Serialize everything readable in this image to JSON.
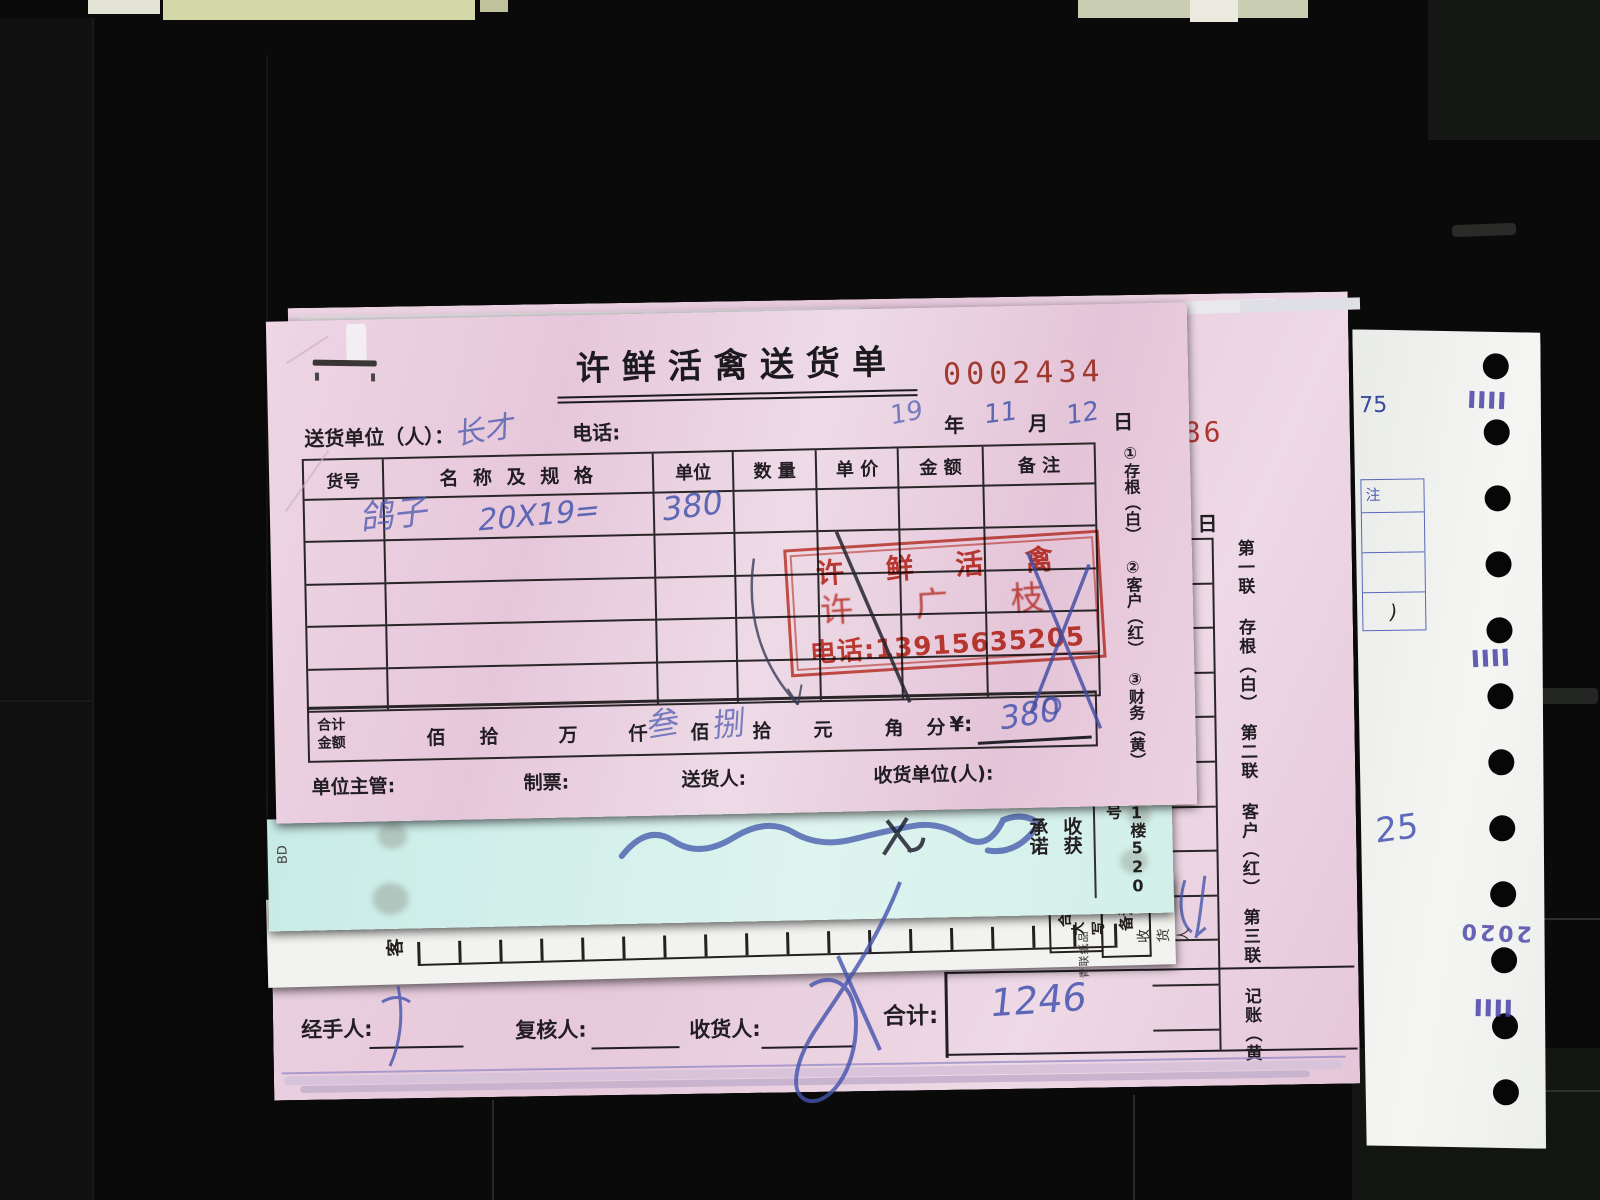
{
  "main_receipt": {
    "title": "许鲜活禽送货单",
    "serial": "0002434",
    "consignor_label": "送货单位（人）：",
    "consignor_hw": "长才",
    "phone_label": "电话:",
    "year_hw": "19",
    "year_label": "年",
    "month_hw": "11",
    "month_label": "月",
    "day_hw": "12",
    "day_label": "日",
    "headers": [
      "货号",
      "名 称 及 规 格",
      "单位",
      "数 量",
      "单 价",
      "金 额",
      "备 注"
    ],
    "item_name": "鸽子",
    "item_spec": "20X19=",
    "item_amount": "380",
    "copies": [
      "①存根（白）",
      "②客户（红）",
      "③财务（黄）"
    ],
    "stamp": {
      "line1": "许 鲜 活 禽",
      "line2": "许 广 枝",
      "line3": "电话:13915635205"
    },
    "total": {
      "label1": "合计",
      "label2": "金额",
      "units": [
        "佰",
        "拾",
        "万",
        "仟",
        "佰",
        "拾",
        "元",
        "角",
        "分"
      ],
      "currency": "¥:",
      "caps1": "叁",
      "caps2": "捌",
      "amount": "380"
    },
    "supervisor_label": "单位主管:",
    "ticket_label": "制票:",
    "deliverer_label": "送货人:",
    "receiver_label": "收货单位(人):"
  },
  "second_receipt": {
    "serial": "486",
    "day_label": "日",
    "note_label": "注",
    "copies_vertical": "第一联 存根（白）　第二联 客户（红）　第三联 记账（黄）",
    "handler_label": "经手人:",
    "reviewer_label": "复核人:",
    "receiver_label": "收货人:",
    "total_label": "合计:",
    "total_hw": "1246"
  },
  "cyan_sheet": {
    "corner_mark": "BD",
    "promise_col1": "承诺",
    "promise_col2": "收获",
    "address": "1楼520号"
  },
  "white_sheet": {
    "customer_label": "客",
    "caps_col1": "合计",
    "caps_col2": "大写",
    "note_label": "备注",
    "receiver_label": "收货人",
    "maker": "青联纸品"
  },
  "tractor_paper": {
    "page_no": "75",
    "note_label": "注",
    "bracket": ")",
    "hw_number": "25",
    "stamp_digits": "2020"
  },
  "colors": {
    "receipt_pink": "#e8cbdc",
    "cyan": "#cdeee9",
    "stamp_red": "#c12a1a",
    "serial_red": "#a03a30",
    "pen_blue": "#4656ae",
    "paper_white": "#f0f1ef",
    "background": "#0a0a0a"
  }
}
